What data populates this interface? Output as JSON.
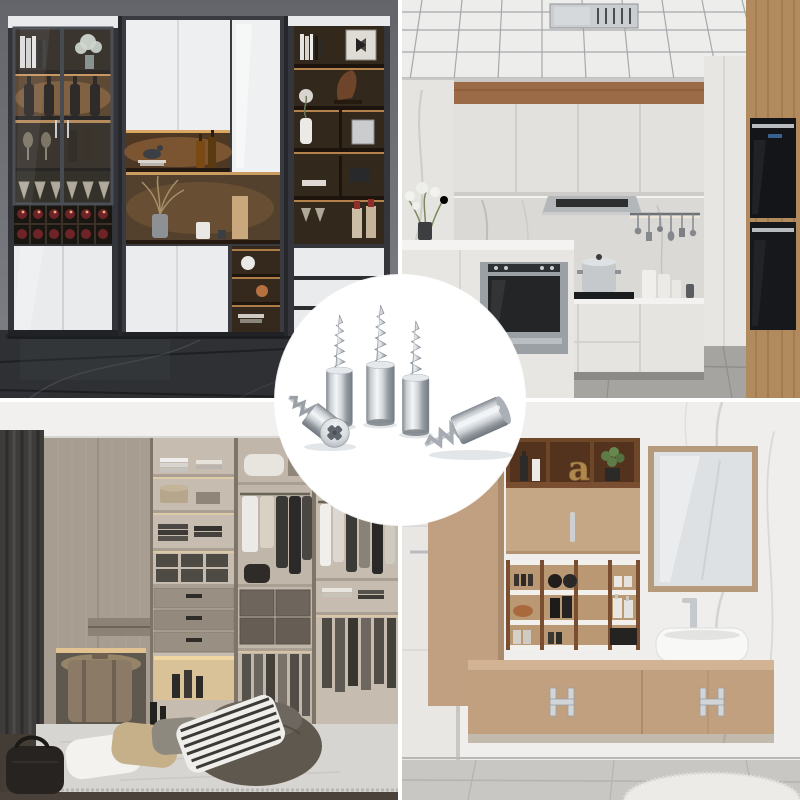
{
  "image": {
    "type": "product-collage",
    "grid": "2x2",
    "divider_color": "#ffffff"
  },
  "center_product": {
    "name": "self-tapping shelf support pegs",
    "finish": "polished chrome",
    "count_total": 5,
    "count_upright": 3,
    "count_lying": 2,
    "head_type": "phillips-cross",
    "badge_shape": "circle",
    "badge_color": "#ffffff",
    "chrome_light": "#f4f6f8",
    "chrome_mid": "#c9ced2",
    "chrome_dark": "#757b82"
  },
  "scenes": {
    "top_left": {
      "name": "wine display cabinet",
      "palette": {
        "wall": "#6e7076",
        "cabinet_frame": "#33343a",
        "interior_wood": "#2a2118",
        "warm_light": "#e0a05c",
        "door_white": "#e9ebec",
        "floor_marble": "#2e3033",
        "wine_bottle": "#6e2427"
      }
    },
    "top_right": {
      "name": "modern white kitchen",
      "palette": {
        "ceiling": "#ededeb",
        "grid_line": "#a5a9ac",
        "wood_trim": "#9a6b46",
        "backsplash_marble": "#dbd9d6",
        "cabinet_white": "#e2e1dd",
        "hood_steel": "#b4b7ba",
        "appliance_black": "#141518",
        "wood_panel": "#b18a5e",
        "floor": "#a5a4a1"
      }
    },
    "bottom_left": {
      "name": "walk-in wardrobe",
      "palette": {
        "ceiling": "#f1f0ee",
        "curtain": "#3d3c3a",
        "wood_taupe": "#a79d90",
        "shelf_interior": "#c6bdb0",
        "drawer": "#998f82",
        "warm_light": "#e9c894",
        "rug": "#d7d5d1",
        "floor_wood": "#443d35",
        "bean_bag": "#6b655d"
      }
    },
    "bottom_right": {
      "name": "bathroom vanity",
      "decor_letter": "a",
      "palette": {
        "wall_marble": "#efeeec",
        "tan_cabinet": "#c1a07f",
        "shelf_wood": "#7a4e30",
        "mirror_glass": "#dee1e3",
        "sink_white": "#f8f8f6",
        "chrome": "#c6c9cc",
        "floor": "#c9c7c3",
        "rug": "#edebe7",
        "decor_gold": "#b0884e"
      }
    }
  }
}
